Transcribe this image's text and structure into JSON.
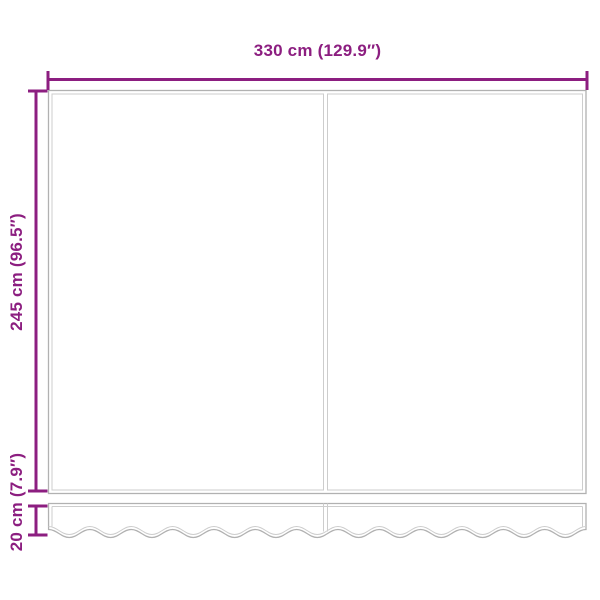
{
  "dimensions": {
    "width": "330 cm (129.9″)",
    "height": "245 cm (96.5″)",
    "valance": "20 cm (7.9″)"
  },
  "colors": {
    "dimension": "#8c1e80",
    "outline": "#b1b1b1",
    "seam": "#cdcdcd",
    "background": "#ffffff"
  }
}
